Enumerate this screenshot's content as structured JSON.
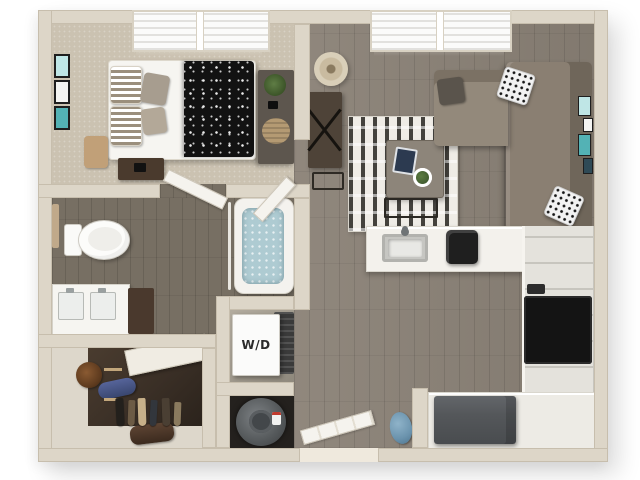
{
  "type": "3d-floor-plan-rendering",
  "visible_text": {
    "laundry_label": "W/D"
  },
  "floor_plan": {
    "rooms": [
      {
        "id": "bedroom",
        "contents": [
          "double-window-blinds",
          "bed",
          "polka-dot-blanket",
          "striped-pillows",
          "accent-pillows",
          "nightstand",
          "storage-ottoman",
          "dresser",
          "potted-plant",
          "three-frame-wall-art",
          "inward-swinging-door"
        ]
      },
      {
        "id": "living-room",
        "contents": [
          "double-window-blinds",
          "l-shaped-sectional-sofa",
          "throw-pillows",
          "striped-area-rug",
          "coffee-table",
          "tablet",
          "table-plant",
          "metal-bench",
          "console-table",
          "x-decor",
          "stool",
          "floor-lamp",
          "gallery-wall-frames"
        ]
      },
      {
        "id": "bathroom",
        "contents": [
          "toilet",
          "towel-bar",
          "double-sink-vanity",
          "vanity-cabinet",
          "bathtub",
          "shower-rod",
          "inward-swinging-door"
        ]
      },
      {
        "id": "walk-in-closet",
        "contents": [
          "hanging-clothes",
          "white-shelf",
          "hat",
          "duffel-bag",
          "purse",
          "hanging-rods"
        ]
      },
      {
        "id": "laundry-closet",
        "label": "W/D",
        "contents": [
          "washer-dryer-unit",
          "dryer-back-unit"
        ]
      },
      {
        "id": "utility-closet",
        "contents": [
          "water-heater"
        ]
      },
      {
        "id": "kitchen",
        "contents": [
          "peninsula-counter",
          "undermount-sink",
          "faucet",
          "countertop-appliance",
          "cabinet-run",
          "four-burner-stove",
          "refrigerator",
          "corner-counter"
        ]
      },
      {
        "id": "entry",
        "contents": [
          "open-front-door",
          "threshold",
          "blue-bag",
          "wall-stub"
        ]
      }
    ],
    "colors": {
      "background": "#ffffff",
      "exterior_wall": "#ddd6c8",
      "bedroom_carpet": "#cbc2b1",
      "wood_floor": "#8a8176",
      "bathroom_floor": "#776f63",
      "closet_floor": "#3e332a",
      "sofa": "#8a7f72",
      "rug_stripe": "#44423d",
      "tub_water": "#aecbd2",
      "stove": "#141414",
      "refrigerator": "#54575a",
      "counter": "#f3f1ec",
      "water_heater": "#63676a",
      "art_accent_teal": "#53b2b5"
    }
  }
}
